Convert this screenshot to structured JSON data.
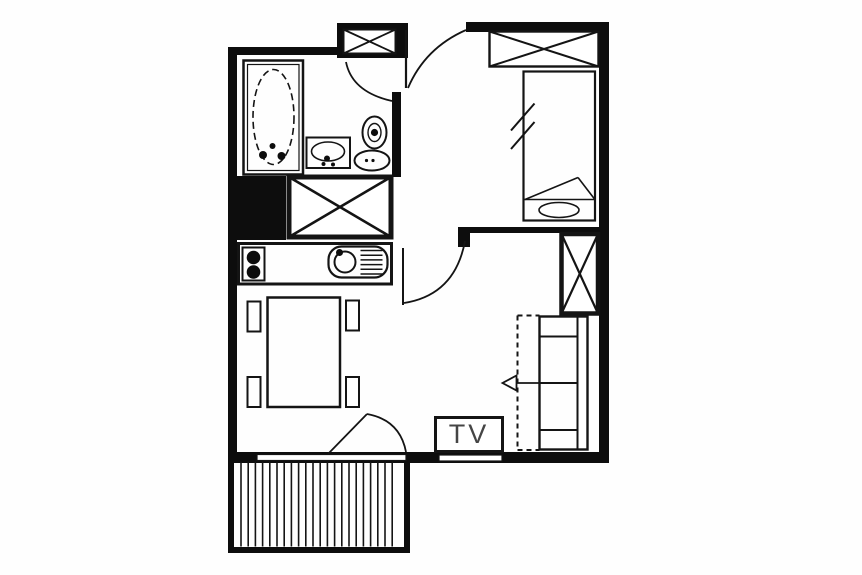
{
  "title": "apartment-floor-plan",
  "labels": {
    "tv": "TV"
  },
  "colors": {
    "bg": "#fefefe",
    "wall": "#0d0d0d",
    "line": "#141414",
    "tv_text": "#454545",
    "white": "#ffffff"
  },
  "floorplan": {
    "canvas": {
      "w": 862,
      "h": 575
    },
    "shapes": [
      {
        "type": "rect",
        "name": "wall-top-bathroom",
        "x": 228,
        "y": 47,
        "w": 110,
        "h": 8,
        "fill": "wall"
      },
      {
        "type": "rect",
        "name": "entry-closet-block",
        "x": 337,
        "y": 23,
        "w": 71,
        "h": 35,
        "fill": "wall"
      },
      {
        "type": "rect",
        "name": "wall-top-bedroom",
        "x": 466,
        "y": 22,
        "w": 143,
        "h": 10,
        "fill": "wall"
      },
      {
        "type": "rect",
        "name": "wall-right",
        "x": 599,
        "y": 22,
        "w": 10,
        "h": 441,
        "fill": "wall"
      },
      {
        "type": "rect",
        "name": "wall-left",
        "x": 228,
        "y": 47,
        "w": 9,
        "h": 416,
        "fill": "wall"
      },
      {
        "type": "rect",
        "name": "wall-bottom",
        "x": 228,
        "y": 452,
        "w": 381,
        "h": 11,
        "fill": "wall"
      },
      {
        "type": "rect",
        "name": "wall-bathroom-right",
        "x": 392,
        "y": 92,
        "w": 9,
        "h": 85,
        "fill": "wall"
      },
      {
        "type": "rect",
        "name": "duct-block",
        "x": 228,
        "y": 176,
        "w": 58,
        "h": 64,
        "fill": "wall"
      },
      {
        "type": "rect",
        "name": "wall-divider-bedroom",
        "x": 458,
        "y": 227,
        "w": 141,
        "h": 6,
        "fill": "wall"
      },
      {
        "type": "rect",
        "name": "wall-divider-stub",
        "x": 458,
        "y": 227,
        "w": 12,
        "h": 20,
        "fill": "wall"
      },
      {
        "type": "rect",
        "name": "window-balcony-strip",
        "x": 257,
        "y": 454.5,
        "w": 149,
        "h": 6,
        "fill": "white",
        "sw": 1.2
      },
      {
        "type": "rect",
        "name": "window-living",
        "x": 439,
        "y": 455,
        "w": 63,
        "h": 6,
        "fill": "white",
        "sw": 1.2
      },
      {
        "type": "rect",
        "name": "balcony-wall-left",
        "x": 228,
        "y": 461,
        "w": 6,
        "h": 92,
        "fill": "wall"
      },
      {
        "type": "rect",
        "name": "balcony-wall-right",
        "x": 404,
        "y": 461,
        "w": 6,
        "h": 92,
        "fill": "wall"
      },
      {
        "type": "rect",
        "name": "balcony-wall-bottom",
        "x": 228,
        "y": 547,
        "w": 182,
        "h": 6,
        "fill": "wall"
      },
      {
        "type": "hatchv",
        "name": "balcony-decking-hatch",
        "x1": 241,
        "x2": 399,
        "step": 7.2,
        "y1": 461.5,
        "y2": 546.5,
        "sw": 1.6
      },
      {
        "type": "line",
        "name": "balcony-door-leaf",
        "x1": 328,
        "y1": 454,
        "x2": 367,
        "y2": 414,
        "sw": 1.8
      },
      {
        "type": "path",
        "name": "balcony-door-arc",
        "d": "M 367 414 Q 400 420 406 452",
        "sw": 1.8
      },
      {
        "type": "xbox",
        "name": "entry-wardrobe",
        "x": 343.5,
        "y": 29.5,
        "w": 52,
        "h": 24,
        "sw": 2,
        "xw": 1.8
      },
      {
        "type": "line",
        "name": "entry-door-leaf",
        "x1": 406,
        "y1": 30,
        "x2": 406,
        "y2": 88,
        "sw": 2.2
      },
      {
        "type": "path",
        "name": "entry-door-arc",
        "d": "M 466 30 Q 425 48 408 88",
        "sw": 1.8
      },
      {
        "type": "path",
        "name": "bathroom-door-arc",
        "d": "M 346 62 Q 352 92 392 101",
        "sw": 1.8
      },
      {
        "type": "line",
        "name": "living-door-leaf",
        "x1": 403,
        "y1": 248,
        "x2": 403,
        "y2": 305,
        "sw": 2
      },
      {
        "type": "path",
        "name": "living-door-arc",
        "d": "M 404 303 Q 455 295 465 241",
        "sw": 1.8
      },
      {
        "type": "rect",
        "name": "bathtub-outer",
        "x": 243.5,
        "y": 60.5,
        "w": 59.5,
        "h": 114,
        "sw": 2.5
      },
      {
        "type": "rect",
        "name": "bathtub-inner",
        "x": 247.5,
        "y": 64.5,
        "w": 51.5,
        "h": 106,
        "sw": 1.2
      },
      {
        "type": "ellipse",
        "name": "bathtub-basin-oval",
        "cx": 273.5,
        "cy": 117,
        "rx": 20.5,
        "ry": 47.5,
        "sw": 1.6,
        "dash": "7 4"
      },
      {
        "type": "dot",
        "name": "bathtub-faucet-dot",
        "cx": 263,
        "cy": 155,
        "r": 4
      },
      {
        "type": "dot",
        "name": "bathtub-faucet-dot",
        "cx": 281.5,
        "cy": 156,
        "r": 4
      },
      {
        "type": "dot",
        "name": "bathtub-drain-dot",
        "cx": 272.5,
        "cy": 146,
        "r": 3
      },
      {
        "type": "rect",
        "name": "washbasin-box",
        "x": 306.5,
        "y": 137.5,
        "w": 43.5,
        "h": 30.5,
        "sw": 2
      },
      {
        "type": "ellipse",
        "name": "washbasin-bowl",
        "cx": 328,
        "cy": 151.5,
        "rx": 16.5,
        "ry": 9.5,
        "sw": 1.6
      },
      {
        "type": "dot",
        "name": "washbasin-faucet-dot",
        "cx": 327,
        "cy": 158.5,
        "r": 3
      },
      {
        "type": "dot",
        "name": "washbasin-dot",
        "cx": 323.5,
        "cy": 164,
        "r": 2
      },
      {
        "type": "dot",
        "name": "washbasin-dot",
        "cx": 333,
        "cy": 164.5,
        "r": 2
      },
      {
        "type": "ellipse",
        "name": "toilet-tank",
        "cx": 374.5,
        "cy": 132.5,
        "rx": 12,
        "ry": 16,
        "sw": 2
      },
      {
        "type": "ellipse",
        "name": "toilet-tank-inner",
        "cx": 374.5,
        "cy": 132.5,
        "rx": 6.5,
        "ry": 9,
        "sw": 1.4
      },
      {
        "type": "dot",
        "name": "toilet-flush-dot",
        "cx": 374.5,
        "cy": 132.5,
        "r": 3.6
      },
      {
        "type": "ellipse",
        "name": "toilet-bowl",
        "cx": 372,
        "cy": 160.5,
        "rx": 17.5,
        "ry": 10,
        "sw": 2
      },
      {
        "type": "dot",
        "name": "toilet-bowl-dot",
        "cx": 366.5,
        "cy": 160.5,
        "r": 1.6
      },
      {
        "type": "dot",
        "name": "toilet-bowl-dot",
        "cx": 373,
        "cy": 160.5,
        "r": 1.6
      },
      {
        "type": "xbox",
        "name": "hall-wardrobe",
        "x": 289,
        "y": 177,
        "w": 102,
        "h": 60,
        "sw": 5,
        "xw": 2.6
      },
      {
        "type": "rect",
        "name": "kitchen-counter",
        "x": 238.5,
        "y": 243.5,
        "w": 153,
        "h": 40.5,
        "sw": 3
      },
      {
        "type": "rect",
        "name": "stove-box",
        "x": 242.5,
        "y": 247.5,
        "w": 22,
        "h": 33,
        "sw": 2
      },
      {
        "type": "dot",
        "name": "stove-burner",
        "cx": 253.5,
        "cy": 257.5,
        "r": 6.8
      },
      {
        "type": "dot",
        "name": "stove-burner",
        "cx": 253.5,
        "cy": 272,
        "r": 6.8
      },
      {
        "type": "rect",
        "name": "kitchen-sink-outline",
        "x": 328.5,
        "y": 246.5,
        "w": 59,
        "h": 31,
        "rx": 13,
        "sw": 2.2
      },
      {
        "type": "ellipse",
        "name": "kitchen-sink-basin",
        "cx": 345,
        "cy": 262,
        "rx": 10.5,
        "ry": 10.5,
        "sw": 2
      },
      {
        "type": "dot",
        "name": "kitchen-faucet-dot",
        "cx": 339.5,
        "cy": 252.5,
        "r": 3.5
      },
      {
        "type": "line",
        "name": "sink-drainer-line",
        "x1": 360.5,
        "y1": 250.5,
        "x2": 382.5,
        "y2": 250.5,
        "sw": 1.5
      },
      {
        "type": "line",
        "name": "sink-drainer-line",
        "x1": 360.5,
        "y1": 255.2,
        "x2": 382.5,
        "y2": 255.2,
        "sw": 1.5
      },
      {
        "type": "line",
        "name": "sink-drainer-line",
        "x1": 360.5,
        "y1": 259.9,
        "x2": 382.5,
        "y2": 259.9,
        "sw": 1.5
      },
      {
        "type": "line",
        "name": "sink-drainer-line",
        "x1": 360.5,
        "y1": 264.6,
        "x2": 382.5,
        "y2": 264.6,
        "sw": 1.5
      },
      {
        "type": "line",
        "name": "sink-drainer-line",
        "x1": 360.5,
        "y1": 269.3,
        "x2": 382.5,
        "y2": 269.3,
        "sw": 1.5
      },
      {
        "type": "line",
        "name": "sink-drainer-line",
        "x1": 360.5,
        "y1": 274,
        "x2": 382.5,
        "y2": 274,
        "sw": 1.5
      },
      {
        "type": "rect",
        "name": "dining-table",
        "x": 267.5,
        "y": 297.5,
        "w": 72.5,
        "h": 109.5,
        "sw": 2.5
      },
      {
        "type": "rect",
        "name": "dining-chair",
        "x": 247.5,
        "y": 301.5,
        "w": 13,
        "h": 30,
        "sw": 2
      },
      {
        "type": "rect",
        "name": "dining-chair",
        "x": 247.5,
        "y": 377,
        "w": 13,
        "h": 30,
        "sw": 2
      },
      {
        "type": "rect",
        "name": "dining-chair",
        "x": 346,
        "y": 300.5,
        "w": 13,
        "h": 30,
        "sw": 2
      },
      {
        "type": "rect",
        "name": "dining-chair",
        "x": 346,
        "y": 377,
        "w": 13,
        "h": 30,
        "sw": 2
      },
      {
        "type": "xbox",
        "name": "bedroom-wardrobe",
        "x": 489.5,
        "y": 31.5,
        "w": 109,
        "h": 35,
        "sw": 2.4,
        "xw": 2
      },
      {
        "type": "rect",
        "name": "bed-outline",
        "x": 523.5,
        "y": 71.5,
        "w": 71.5,
        "h": 149,
        "sw": 2.2
      },
      {
        "type": "line",
        "name": "bed-footer-line",
        "x1": 523.5,
        "y1": 199.5,
        "x2": 595,
        "y2": 199.5,
        "sw": 1.6
      },
      {
        "type": "ellipse",
        "name": "bed-pillow",
        "cx": 559,
        "cy": 210,
        "rx": 20,
        "ry": 7.5,
        "sw": 1.6
      },
      {
        "type": "line",
        "name": "bed-fold-line",
        "x1": 525,
        "y1": 199.5,
        "x2": 578,
        "y2": 177.5,
        "sw": 1.6
      },
      {
        "type": "line",
        "name": "bed-fold-line",
        "x1": 578,
        "y1": 177.5,
        "x2": 594.5,
        "y2": 199,
        "sw": 1.6
      },
      {
        "type": "line",
        "name": "bed-break-mark",
        "x1": 511,
        "y1": 130.5,
        "x2": 534.5,
        "y2": 103.5,
        "sw": 2
      },
      {
        "type": "line",
        "name": "bed-break-mark",
        "x1": 511,
        "y1": 149,
        "x2": 534.5,
        "y2": 122,
        "sw": 2
      },
      {
        "type": "xbox",
        "name": "divider-wardrobe",
        "x": 561.5,
        "y": 234,
        "w": 36.5,
        "h": 79.5,
        "sw": 4.5,
        "xw": 2.2
      },
      {
        "type": "rect",
        "name": "sofa-outline",
        "x": 539.5,
        "y": 316.5,
        "w": 48,
        "h": 133,
        "sw": 2.4
      },
      {
        "type": "line",
        "name": "sofa-backrest-line",
        "x1": 577.5,
        "y1": 316.5,
        "x2": 577.5,
        "y2": 449.5,
        "sw": 2
      },
      {
        "type": "line",
        "name": "sofa-section-line",
        "x1": 539.5,
        "y1": 336.5,
        "x2": 577.5,
        "y2": 336.5,
        "sw": 2
      },
      {
        "type": "line",
        "name": "sofa-section-line",
        "x1": 539.5,
        "y1": 383,
        "x2": 577.5,
        "y2": 383,
        "sw": 2
      },
      {
        "type": "line",
        "name": "sofa-section-line",
        "x1": 539.5,
        "y1": 430,
        "x2": 577.5,
        "y2": 430,
        "sw": 2
      },
      {
        "type": "line",
        "name": "sofabed-dashed-edge",
        "x1": 517.5,
        "y1": 315.5,
        "x2": 517.5,
        "y2": 450,
        "sw": 2,
        "dash": "5 4"
      },
      {
        "type": "line",
        "name": "sofabed-dashed-edge",
        "x1": 517.5,
        "y1": 315.5,
        "x2": 539.5,
        "y2": 315.5,
        "sw": 2,
        "dash": "5 4"
      },
      {
        "type": "line",
        "name": "sofabed-dashed-edge",
        "x1": 517.5,
        "y1": 450,
        "x2": 539.5,
        "y2": 450,
        "sw": 2,
        "dash": "5 4"
      },
      {
        "type": "line",
        "name": "sofabed-arrow-shaft",
        "x1": 516.5,
        "y1": 383,
        "x2": 577,
        "y2": 383,
        "sw": 1.8
      },
      {
        "type": "poly",
        "name": "sofabed-arrow-head",
        "points": "502.5,383 516.5,375.5 516.5,390.5",
        "sw": 1.8,
        "fill": "white"
      },
      {
        "type": "rect",
        "name": "tv-box",
        "x": 435.5,
        "y": 417.5,
        "w": 67,
        "h": 34,
        "sw": 3,
        "fill": "white"
      }
    ]
  }
}
